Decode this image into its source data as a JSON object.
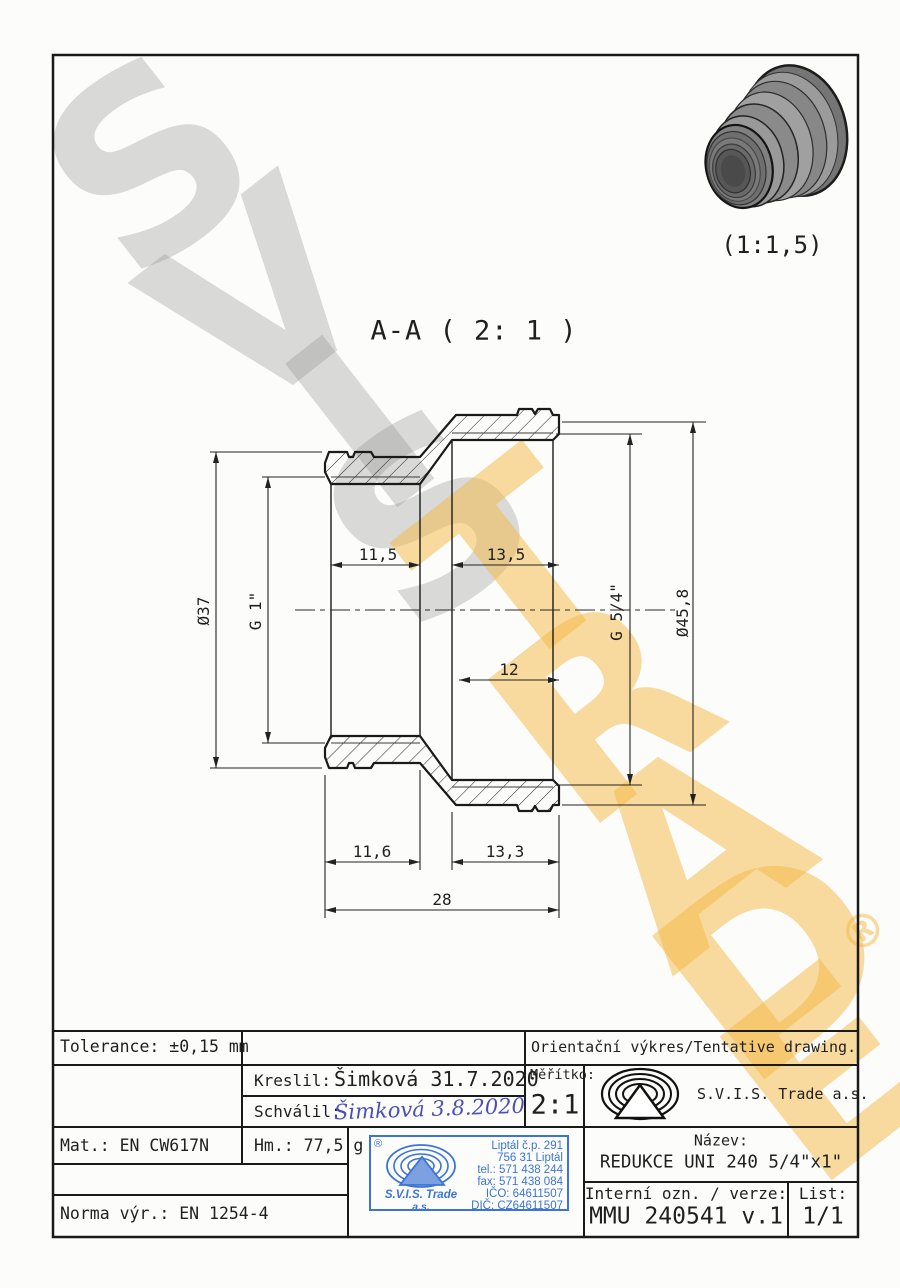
{
  "watermark": {
    "letters": [
      "S",
      "V",
      "I",
      "S",
      "T",
      "R",
      "A",
      "D",
      "E"
    ],
    "registered": "®",
    "gray": "#919191",
    "yellow": "#f3ba48"
  },
  "view3d": {
    "scale_label": "(1:1,5)"
  },
  "section": {
    "title": "A-A ( 2: 1 )",
    "dims": {
      "top_left": "11,5",
      "top_right": "13,5",
      "mid_right": "12",
      "bottom_left": "11,6",
      "bottom_right": "13,3",
      "overall": "28",
      "left_outer_dia": "Ø37",
      "left_thread": "G 1\"",
      "right_thread": "G 5/4\"",
      "right_outer_dia": "Ø45,8"
    }
  },
  "title_block": {
    "tolerance": "Tolerance: ±0,15 mm",
    "orientation_note": "Orientační výkres/Tentative drawing.",
    "kreslil_label": "Kreslil:",
    "kreslil_value": "Šimková 31.7.2020",
    "schvalil_label": "Schválil:",
    "schvalil_value": "Šimková 3.8.2020",
    "meritko_label": "Měřítko:",
    "meritko_value": "2:1",
    "company": "S.V.I.S. Trade a.s.",
    "mat": "Mat.: EN CW617N",
    "hm": "Hm.: 77,5 g",
    "norma": "Norma výr.: EN 1254-4",
    "nazev_label": "Název:",
    "nazev_value": "REDUKCE UNI 240 5/4\"x1\"",
    "interni_label": "Interní ozn. / verze:",
    "interni_value": "MMU 240541 v.1",
    "list_label": "List:",
    "list_value": "1/1"
  },
  "stamp": {
    "registered": "®",
    "company_line1": "S.V.I.S. Trade",
    "company_line2": "a.s.",
    "address1": "Liptál č.p. 291",
    "address2": "756 31 Liptál",
    "tel": "tel.: 571 438 244",
    "fax": "fax: 571 438 084",
    "ico": "IČO: 64611507",
    "dic": "DIČ: CZ64611507",
    "color": "#3b74d6"
  }
}
